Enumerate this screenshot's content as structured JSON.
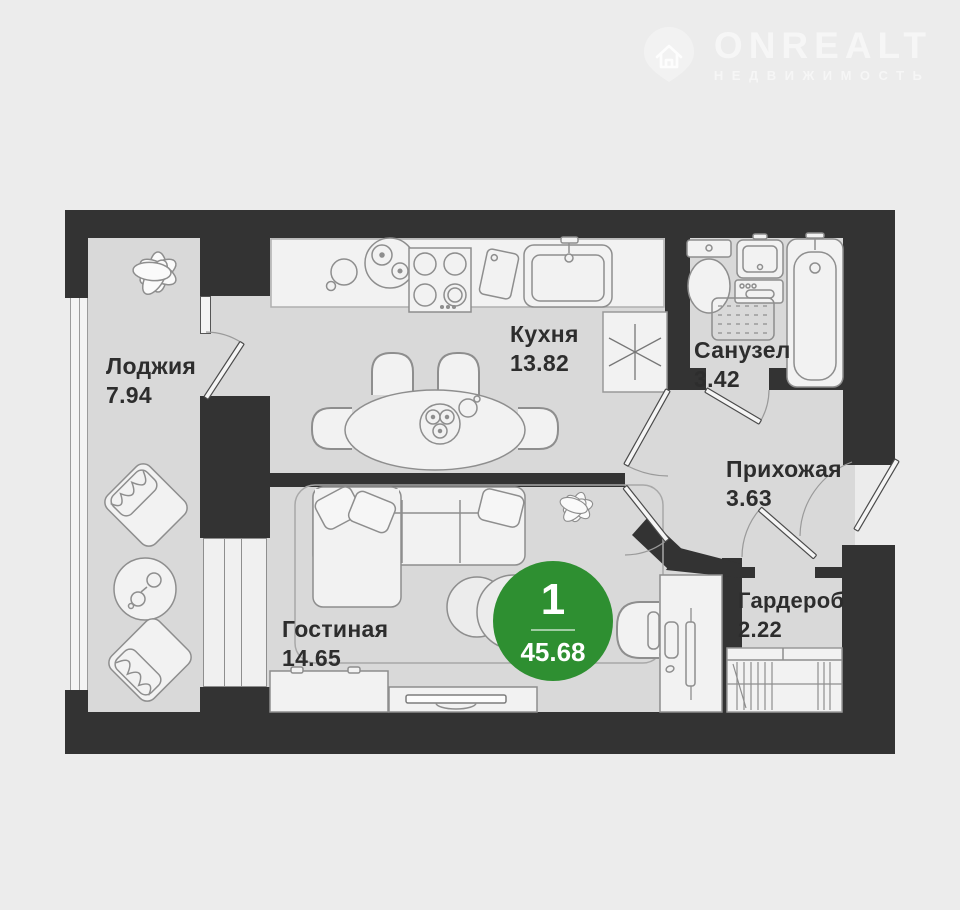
{
  "brand": {
    "name": "ONREALT",
    "subtitle": "НЕДВИЖИМОСТЬ",
    "icon": "house-pin-icon"
  },
  "badge": {
    "rooms": "1",
    "total_area": "45.68"
  },
  "rooms": [
    {
      "id": "loggia",
      "name": "Лоджия",
      "area": "7.94"
    },
    {
      "id": "kitchen",
      "name": "Кухня",
      "area": "13.82"
    },
    {
      "id": "bathroom",
      "name": "Санузел",
      "area": "3.42"
    },
    {
      "id": "hallway",
      "name": "Прихожая",
      "area": "3.63"
    },
    {
      "id": "living",
      "name": "Гостиная",
      "area": "14.65"
    },
    {
      "id": "wardrobe",
      "name": "Гардероб",
      "area": "2.22"
    }
  ],
  "colors": {
    "background": "#ececec",
    "floor": "#d9d9d9",
    "wall": "#333333",
    "furniture": "#f2f2f2",
    "accent_green": "#2e8f31",
    "logo": "#f6f6f6"
  }
}
